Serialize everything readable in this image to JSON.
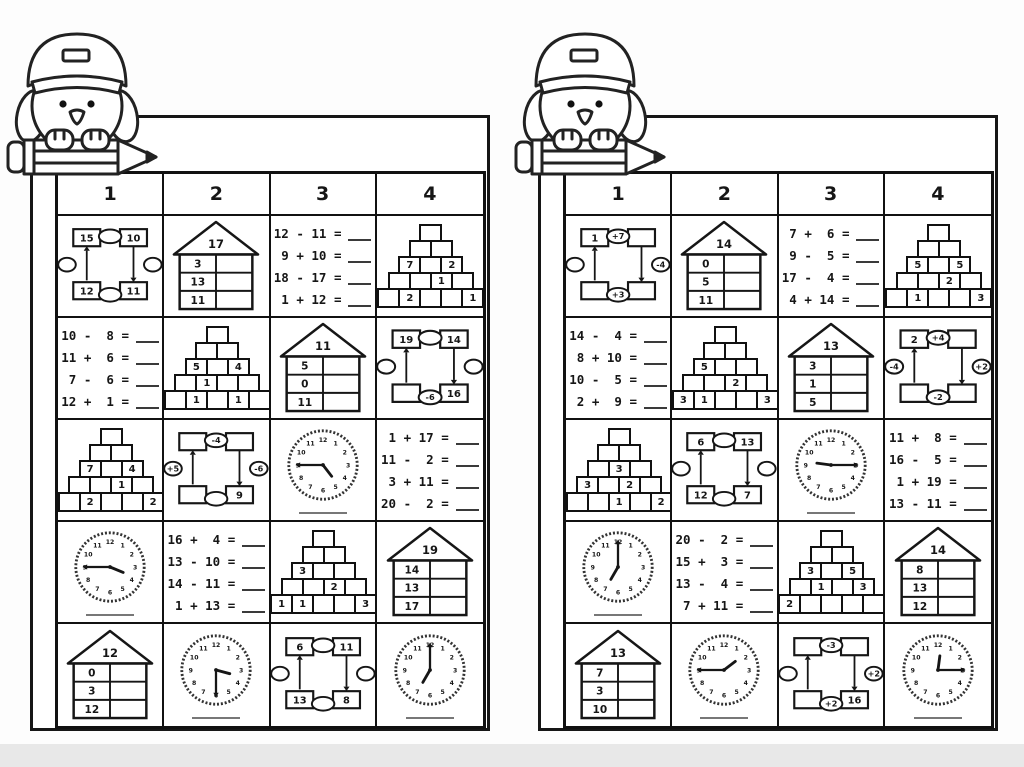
{
  "page": {
    "background": "#fdfdfd",
    "footer_bar_color": "#e8e8e8",
    "ink_color": "#161616",
    "mascot": "owl-wearing-cap-sitting-on-pencil"
  },
  "panels": [
    {
      "id": "left-worksheet",
      "column_headers": [
        "1",
        "2",
        "3",
        "4"
      ],
      "rows": [
        [
          {
            "type": "circle",
            "boxes": {
              "tl": "15",
              "tr": "10",
              "bl": "12",
              "br": "11"
            },
            "ovals": {
              "top": "",
              "right": "",
              "bottom": "",
              "left": ""
            }
          },
          {
            "type": "house",
            "roof": "17",
            "rows": [
              "3",
              "13",
              "11"
            ]
          },
          {
            "type": "equations",
            "items": [
              {
                "a": "12",
                "op": "-",
                "b": "11"
              },
              {
                "a": "9",
                "op": "+",
                "b": "10"
              },
              {
                "a": "18",
                "op": "-",
                "b": "17"
              },
              {
                "a": "1",
                "op": "+",
                "b": "12"
              }
            ]
          },
          {
            "type": "pyramid",
            "rows": [
              [
                ""
              ],
              [
                "",
                ""
              ],
              [
                "7",
                "",
                "2"
              ],
              [
                "",
                "",
                "1",
                ""
              ],
              [
                "",
                "2",
                "",
                "",
                "1"
              ]
            ]
          }
        ],
        [
          {
            "type": "equations",
            "items": [
              {
                "a": "10",
                "op": "-",
                "b": "8"
              },
              {
                "a": "11",
                "op": "+",
                "b": "6"
              },
              {
                "a": "7",
                "op": "-",
                "b": "6"
              },
              {
                "a": "12",
                "op": "+",
                "b": "1"
              }
            ]
          },
          {
            "type": "pyramid",
            "rows": [
              [
                ""
              ],
              [
                "",
                ""
              ],
              [
                "5",
                "",
                "4"
              ],
              [
                "",
                "1",
                "",
                ""
              ],
              [
                "",
                "1",
                "",
                "1",
                ""
              ]
            ]
          },
          {
            "type": "house",
            "roof": "11",
            "rows": [
              "5",
              "0",
              "11"
            ]
          },
          {
            "type": "circle",
            "boxes": {
              "tl": "19",
              "tr": "14",
              "bl": "",
              "br": "16"
            },
            "ovals": {
              "top": "",
              "right": "",
              "bottom": "-6",
              "left": ""
            }
          }
        ],
        [
          {
            "type": "pyramid",
            "rows": [
              [
                ""
              ],
              [
                "",
                ""
              ],
              [
                "7",
                "",
                "4"
              ],
              [
                "",
                "",
                "1",
                ""
              ],
              [
                "",
                "2",
                "",
                "",
                "2"
              ]
            ]
          },
          {
            "type": "circle",
            "boxes": {
              "tl": "",
              "tr": "",
              "bl": "",
              "br": "9"
            },
            "ovals": {
              "top": "-4",
              "right": "-6",
              "bottom": "",
              "left": "+5"
            }
          },
          {
            "type": "clock",
            "time": "4:45"
          },
          {
            "type": "equations",
            "items": [
              {
                "a": "1",
                "op": "+",
                "b": "17"
              },
              {
                "a": "11",
                "op": "-",
                "b": "2"
              },
              {
                "a": "3",
                "op": "+",
                "b": "11"
              },
              {
                "a": "20",
                "op": "-",
                "b": "2"
              }
            ]
          }
        ],
        [
          {
            "type": "clock",
            "time": "3:45"
          },
          {
            "type": "equations",
            "items": [
              {
                "a": "16",
                "op": "+",
                "b": "4"
              },
              {
                "a": "13",
                "op": "-",
                "b": "10"
              },
              {
                "a": "14",
                "op": "-",
                "b": "11"
              },
              {
                "a": "1",
                "op": "+",
                "b": "13"
              }
            ]
          },
          {
            "type": "pyramid",
            "rows": [
              [
                ""
              ],
              [
                "",
                ""
              ],
              [
                "3",
                "",
                ""
              ],
              [
                "",
                "",
                "2",
                ""
              ],
              [
                "1",
                "1",
                "",
                "",
                "3"
              ]
            ]
          },
          {
            "type": "house",
            "roof": "19",
            "rows": [
              "14",
              "13",
              "17"
            ]
          }
        ],
        [
          {
            "type": "house",
            "roof": "12",
            "rows": [
              "0",
              "3",
              "12"
            ]
          },
          {
            "type": "clock",
            "time": "3:30"
          },
          {
            "type": "circle",
            "boxes": {
              "tl": "6",
              "tr": "11",
              "bl": "13",
              "br": "8"
            },
            "ovals": {
              "top": "",
              "right": "",
              "bottom": "",
              "left": ""
            }
          },
          {
            "type": "clock",
            "time": "7:00"
          }
        ]
      ]
    },
    {
      "id": "right-worksheet",
      "column_headers": [
        "1",
        "2",
        "3",
        "4"
      ],
      "rows": [
        [
          {
            "type": "circle",
            "boxes": {
              "tl": "1",
              "tr": "",
              "bl": "",
              "br": ""
            },
            "ovals": {
              "top": "+7",
              "right": "-4",
              "bottom": "+3",
              "left": ""
            }
          },
          {
            "type": "house",
            "roof": "14",
            "rows": [
              "0",
              "5",
              "11"
            ]
          },
          {
            "type": "equations",
            "items": [
              {
                "a": "7",
                "op": "+",
                "b": "6"
              },
              {
                "a": "9",
                "op": "-",
                "b": "5"
              },
              {
                "a": "17",
                "op": "-",
                "b": "4"
              },
              {
                "a": "4",
                "op": "+",
                "b": "14"
              }
            ]
          },
          {
            "type": "pyramid",
            "rows": [
              [
                ""
              ],
              [
                "",
                ""
              ],
              [
                "5",
                "",
                "5"
              ],
              [
                "",
                "",
                "2",
                ""
              ],
              [
                "",
                "1",
                "",
                "",
                "3"
              ]
            ]
          }
        ],
        [
          {
            "type": "equations",
            "items": [
              {
                "a": "14",
                "op": "-",
                "b": "4"
              },
              {
                "a": "8",
                "op": "+",
                "b": "10"
              },
              {
                "a": "10",
                "op": "-",
                "b": "5"
              },
              {
                "a": "2",
                "op": "+",
                "b": "9"
              }
            ]
          },
          {
            "type": "pyramid",
            "rows": [
              [
                ""
              ],
              [
                "",
                ""
              ],
              [
                "5",
                "",
                ""
              ],
              [
                "",
                "",
                "2",
                ""
              ],
              [
                "3",
                "1",
                "",
                "",
                "3"
              ]
            ]
          },
          {
            "type": "house",
            "roof": "13",
            "rows": [
              "3",
              "1",
              "5"
            ]
          },
          {
            "type": "circle",
            "boxes": {
              "tl": "2",
              "tr": "",
              "bl": "",
              "br": ""
            },
            "ovals": {
              "top": "+4",
              "right": "+2",
              "bottom": "-2",
              "left": "-4"
            }
          }
        ],
        [
          {
            "type": "pyramid",
            "rows": [
              [
                ""
              ],
              [
                "",
                ""
              ],
              [
                "",
                "3",
                ""
              ],
              [
                "3",
                "",
                "2",
                ""
              ],
              [
                "",
                "",
                "1",
                "",
                "2"
              ]
            ]
          },
          {
            "type": "circle",
            "boxes": {
              "tl": "6",
              "tr": "13",
              "bl": "12",
              "br": "7"
            },
            "ovals": {
              "top": "",
              "right": "",
              "bottom": "",
              "left": ""
            }
          },
          {
            "type": "clock",
            "time": "9:15"
          },
          {
            "type": "equations",
            "items": [
              {
                "a": "11",
                "op": "+",
                "b": "8"
              },
              {
                "a": "16",
                "op": "-",
                "b": "5"
              },
              {
                "a": "1",
                "op": "+",
                "b": "19"
              },
              {
                "a": "13",
                "op": "-",
                "b": "11"
              }
            ]
          }
        ],
        [
          {
            "type": "clock",
            "time": "7:00"
          },
          {
            "type": "equations",
            "items": [
              {
                "a": "20",
                "op": "-",
                "b": "2"
              },
              {
                "a": "15",
                "op": "+",
                "b": "3"
              },
              {
                "a": "13",
                "op": "-",
                "b": "4"
              },
              {
                "a": "7",
                "op": "+",
                "b": "11"
              }
            ]
          },
          {
            "type": "pyramid",
            "rows": [
              [
                ""
              ],
              [
                "",
                ""
              ],
              [
                "3",
                "",
                "5"
              ],
              [
                "",
                "1",
                "",
                "3"
              ],
              [
                "2",
                "",
                "",
                "",
                ""
              ]
            ]
          },
          {
            "type": "house",
            "roof": "14",
            "rows": [
              "8",
              "13",
              "12"
            ]
          }
        ],
        [
          {
            "type": "house",
            "roof": "13",
            "rows": [
              "7",
              "3",
              "10"
            ]
          },
          {
            "type": "clock",
            "time": "1:45"
          },
          {
            "type": "circle",
            "boxes": {
              "tl": "",
              "tr": "",
              "bl": "",
              "br": "16"
            },
            "ovals": {
              "top": "-3",
              "right": "+2",
              "bottom": "+2",
              "left": ""
            }
          },
          {
            "type": "clock",
            "time": "12:15"
          }
        ]
      ]
    }
  ]
}
